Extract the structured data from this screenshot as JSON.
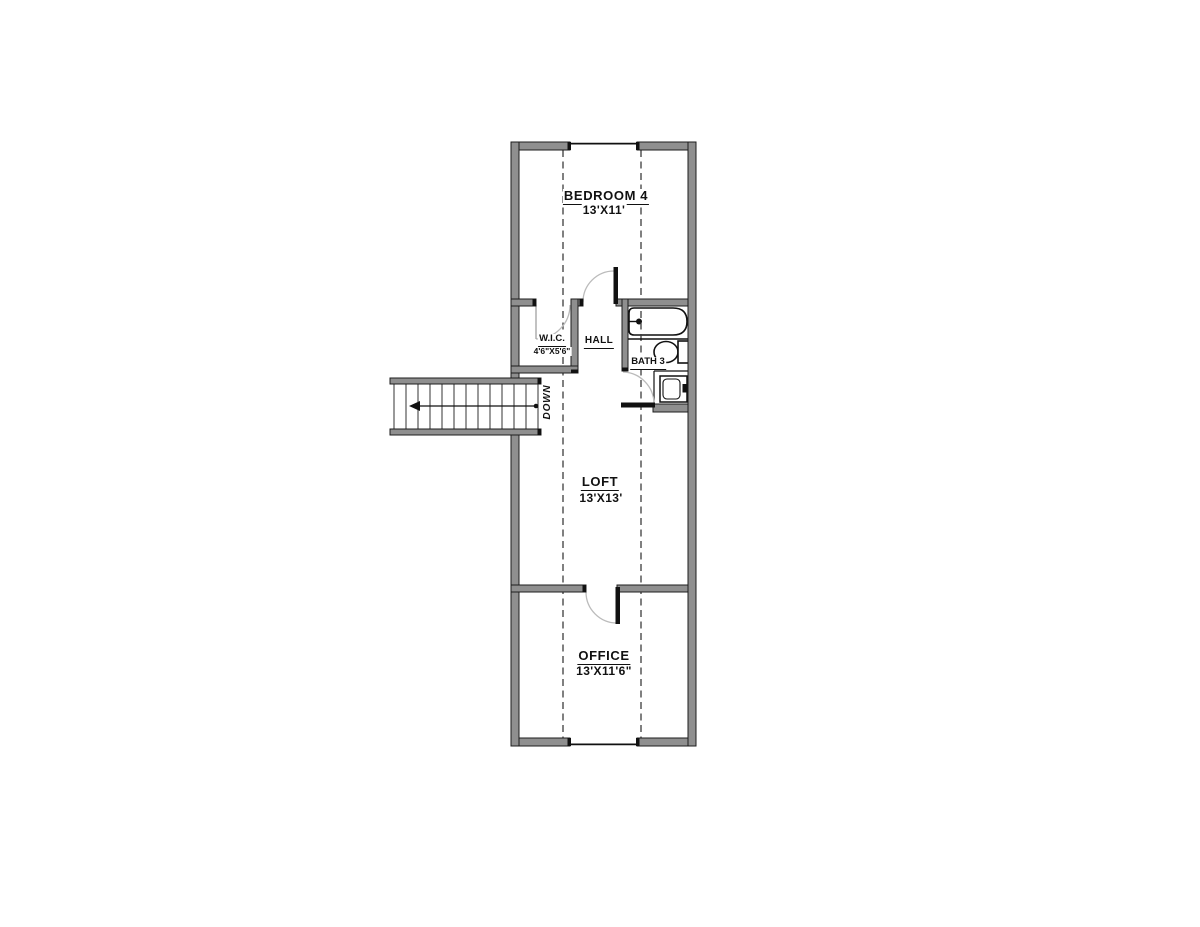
{
  "labels": {
    "bedroom4": {
      "name": "BEDROOM 4",
      "dims": "13'X11'"
    },
    "wic": {
      "name": "W.I.C.",
      "dims": "4'6\"X5'6\""
    },
    "hall": {
      "name": "HALL"
    },
    "bath3": {
      "name": "BATH 3"
    },
    "loft": {
      "name": "LOFT",
      "dims": "13'X13'"
    },
    "office": {
      "name": "OFFICE",
      "dims": "13'X11'6\""
    },
    "stairs": {
      "direction": "DOWN"
    }
  },
  "colors": {
    "background": "#ffffff",
    "wall_fill": "#8f8f8f",
    "wall_edge": "#1c1c1c",
    "line": "#111111",
    "door_arc": "#bbbbbb",
    "dashed_line": "#3c3c3c"
  }
}
